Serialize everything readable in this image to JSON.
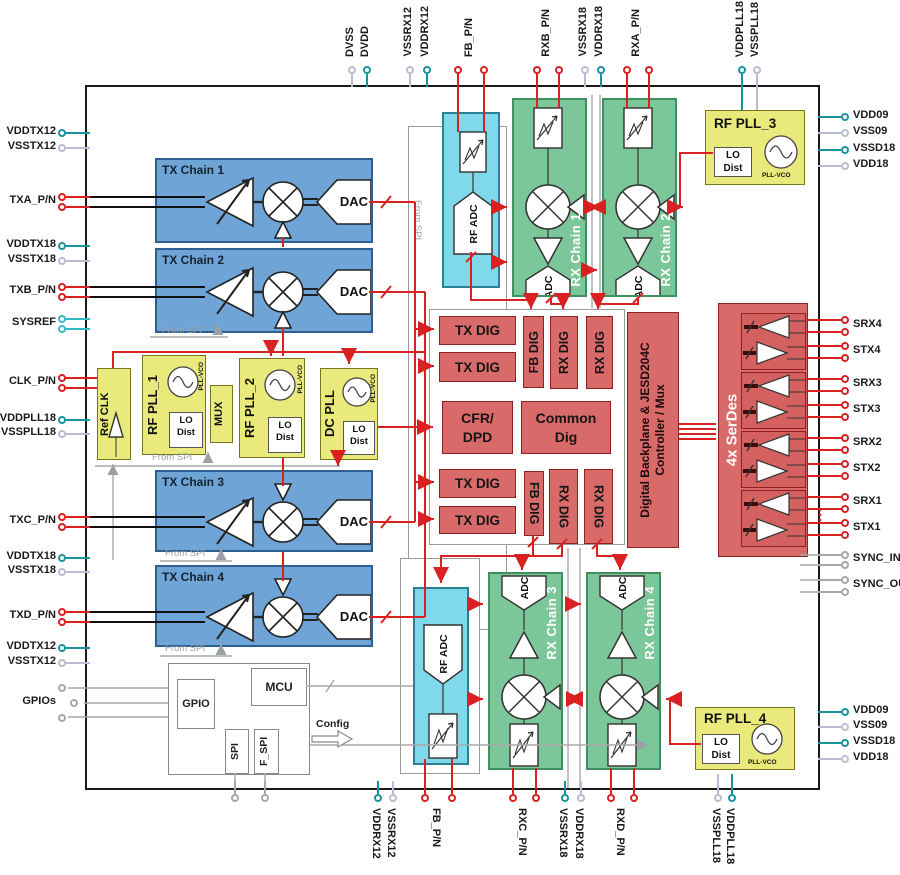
{
  "diagram": {
    "tx_chain_labels": [
      "TX Chain 1",
      "TX Chain 2",
      "TX Chain 3",
      "TX Chain 4"
    ],
    "rx_chain_labels": [
      "RX Chain 1",
      "RX Chain 2",
      "RX Chain 3",
      "RX Chain 4"
    ],
    "dac": "DAC",
    "adc": "ADC",
    "rf_adc": "RF ADC",
    "digital": {
      "tx_dig": "TX DIG",
      "fb_dig": "FB DIG",
      "rx_dig": "RX DIG",
      "cfr_line1": "CFR/",
      "cfr_line2": "DPD",
      "common_line1": "Common",
      "common_line2": "Dig",
      "backplane_line1": "Digital Backplane & JESD204C",
      "backplane_line2": "Controller / Mux",
      "serdes": "4x SerDes"
    },
    "clocking": {
      "ref_clk": "Ref CLK",
      "rf_pll_1": "RF PLL_1",
      "rf_pll_2": "RF PLL_2",
      "dc_pll": "DC PLL",
      "rf_pll_3": "RF PLL_3",
      "rf_pll_4": "RF PLL_4",
      "mux": "MUX",
      "lo": "LO",
      "dist": "Dist",
      "pll_vco": "PLL-VCO"
    },
    "control": {
      "gpio": "GPIO",
      "mcu": "MCU",
      "spi": "SPI",
      "f_spi": "F_SPI",
      "config": "Config"
    },
    "from_spi": "From SPI"
  },
  "colors": {
    "tx_blue": "#6fa4d6",
    "rx_green": "#7cc79a",
    "adc_cyan": "#7fd9ea",
    "pll_yellow": "#e9e97c",
    "digital_red": "#d96a6a",
    "wire_red": "#d92121",
    "power_teal": "#18939e",
    "power_gray": "#b9bdd1",
    "sysref_cyan": "#3ab7c6"
  },
  "pins": {
    "left": [
      {
        "l": "VDDTX12",
        "k": "teal",
        "y": 133,
        "o": [
          0
        ]
      },
      {
        "l": "VSSTX12",
        "k": "gray",
        "y": 148,
        "o": [
          0
        ]
      },
      {
        "l": "TXA_P/N",
        "k": "red",
        "y": 202,
        "o": [
          -5,
          5
        ]
      },
      {
        "l": "VDDTX18",
        "k": "teal",
        "y": 246,
        "o": [
          0
        ]
      },
      {
        "l": "VSSTX18",
        "k": "gray",
        "y": 261,
        "o": [
          0
        ]
      },
      {
        "l": "TXB_P/N",
        "k": "red",
        "y": 292,
        "o": [
          -5,
          5
        ]
      },
      {
        "l": "SYSREF",
        "k": "cyan",
        "y": 324,
        "o": [
          -5,
          5
        ]
      },
      {
        "l": "CLK_P/N",
        "k": "red",
        "y": 383,
        "o": [
          -5,
          5
        ]
      },
      {
        "l": "VDDPLL18",
        "k": "teal",
        "y": 420,
        "o": [
          0
        ]
      },
      {
        "l": "VSSPLL18",
        "k": "gray",
        "y": 434,
        "o": [
          0
        ]
      },
      {
        "l": "TXC_P/N",
        "k": "red",
        "y": 522,
        "o": [
          -5,
          5
        ]
      },
      {
        "l": "VDDTX18",
        "k": "teal",
        "y": 558,
        "o": [
          0
        ]
      },
      {
        "l": "VSSTX18",
        "k": "gray",
        "y": 572,
        "o": [
          0
        ]
      },
      {
        "l": "TXD_P/N",
        "k": "red",
        "y": 617,
        "o": [
          -5,
          5
        ]
      },
      {
        "l": "VDDTX12",
        "k": "teal",
        "y": 648,
        "o": [
          0
        ]
      },
      {
        "l": "VSSTX12",
        "k": "gray",
        "y": 663,
        "o": [
          0
        ]
      },
      {
        "l": "GPIOs",
        "k": "gpio",
        "y": 703,
        "o": [
          -15,
          0,
          15
        ]
      }
    ],
    "top": [
      {
        "l": "DVSS",
        "k": "gray",
        "x": 352,
        "o": [
          0
        ]
      },
      {
        "l": "DVDD",
        "k": "teal",
        "x": 367,
        "o": [
          0
        ]
      },
      {
        "l": "VSSRX12",
        "k": "gray",
        "x": 410,
        "o": [
          0
        ]
      },
      {
        "l": "VDDRX12",
        "k": "teal",
        "x": 427,
        "o": [
          0
        ]
      },
      {
        "l": "FB_P/N",
        "k": "red",
        "x": 471,
        "o": [
          -13,
          13
        ]
      },
      {
        "l": "RXB_P/N",
        "k": "red",
        "x": 548,
        "o": [
          -11,
          11
        ]
      },
      {
        "l": "VSSRX18",
        "k": "gray",
        "x": 585,
        "o": [
          0
        ]
      },
      {
        "l": "VDDRX18",
        "k": "teal",
        "x": 601,
        "o": [
          0
        ]
      },
      {
        "l": "RXA_P/N",
        "k": "red",
        "x": 638,
        "o": [
          -11,
          11
        ]
      },
      {
        "l": "VDDPLL18",
        "k": "teal",
        "x": 742,
        "o": [
          0
        ]
      },
      {
        "l": "VSSPLL18",
        "k": "gray",
        "x": 757,
        "o": [
          0
        ]
      }
    ],
    "right": [
      {
        "l": "VDD09",
        "k": "teal",
        "y": 117,
        "o": [
          0
        ]
      },
      {
        "l": "VSS09",
        "k": "gray",
        "y": 133,
        "o": [
          0
        ]
      },
      {
        "l": "VSSD18",
        "k": "teal",
        "y": 150,
        "o": [
          0
        ]
      },
      {
        "l": "VDD18",
        "k": "gray",
        "y": 166,
        "o": [
          0
        ]
      },
      {
        "l": "SRX4",
        "k": "red",
        "y": 326,
        "o": [
          -6,
          6
        ]
      },
      {
        "l": "STX4",
        "k": "red",
        "y": 352,
        "o": [
          -6,
          6
        ]
      },
      {
        "l": "SRX3",
        "k": "red",
        "y": 385,
        "o": [
          -6,
          6
        ]
      },
      {
        "l": "STX3",
        "k": "red",
        "y": 411,
        "o": [
          -6,
          6
        ]
      },
      {
        "l": "SRX2",
        "k": "red",
        "y": 444,
        "o": [
          -6,
          6
        ]
      },
      {
        "l": "STX2",
        "k": "red",
        "y": 470,
        "o": [
          -6,
          6
        ]
      },
      {
        "l": "SRX1",
        "k": "red",
        "y": 503,
        "o": [
          -6,
          6
        ]
      },
      {
        "l": "STX1",
        "k": "red",
        "y": 529,
        "o": [
          -6,
          6
        ]
      },
      {
        "l": "SYNC_IN",
        "k": "sync",
        "y": 560,
        "o": [
          -5,
          5
        ]
      },
      {
        "l": "SYNC_OUT",
        "k": "sync",
        "y": 586,
        "o": [
          -6,
          6
        ]
      },
      {
        "l": "VDD09",
        "k": "teal",
        "y": 712,
        "o": [
          0
        ]
      },
      {
        "l": "VSS09",
        "k": "gray",
        "y": 727,
        "o": [
          0
        ]
      },
      {
        "l": "VSSD18",
        "k": "teal",
        "y": 743,
        "o": [
          0
        ]
      },
      {
        "l": "VDD18",
        "k": "gray",
        "y": 759,
        "o": [
          0
        ]
      }
    ],
    "bottom": [
      {
        "l": "VDDRX12",
        "k": "teal",
        "x": 378,
        "o": [
          0
        ]
      },
      {
        "l": "VSSRX12",
        "k": "gray",
        "x": 393,
        "o": [
          0
        ]
      },
      {
        "l": "FB_P/N",
        "k": "red",
        "x": 438,
        "o": [
          -13,
          14
        ]
      },
      {
        "l": "RXC_P/N",
        "k": "red",
        "x": 524,
        "o": [
          -11,
          12
        ]
      },
      {
        "l": "VSSRX18",
        "k": "teal",
        "x": 565,
        "o": [
          0
        ]
      },
      {
        "l": "VDDRX18",
        "k": "gray",
        "x": 581,
        "o": [
          0
        ]
      },
      {
        "l": "RXD_P/N",
        "k": "red",
        "x": 622,
        "o": [
          -11,
          12
        ]
      },
      {
        "l": "VSSPLL18",
        "k": "gray",
        "x": 718,
        "o": [
          0
        ]
      },
      {
        "l": "VDDPLL18",
        "k": "teal",
        "x": 732,
        "o": [
          0
        ]
      },
      {
        "l": "",
        "k": "gpio",
        "x": 235,
        "o": [
          0
        ]
      },
      {
        "l": "",
        "k": "gpio",
        "x": 265,
        "o": [
          0
        ]
      }
    ]
  }
}
